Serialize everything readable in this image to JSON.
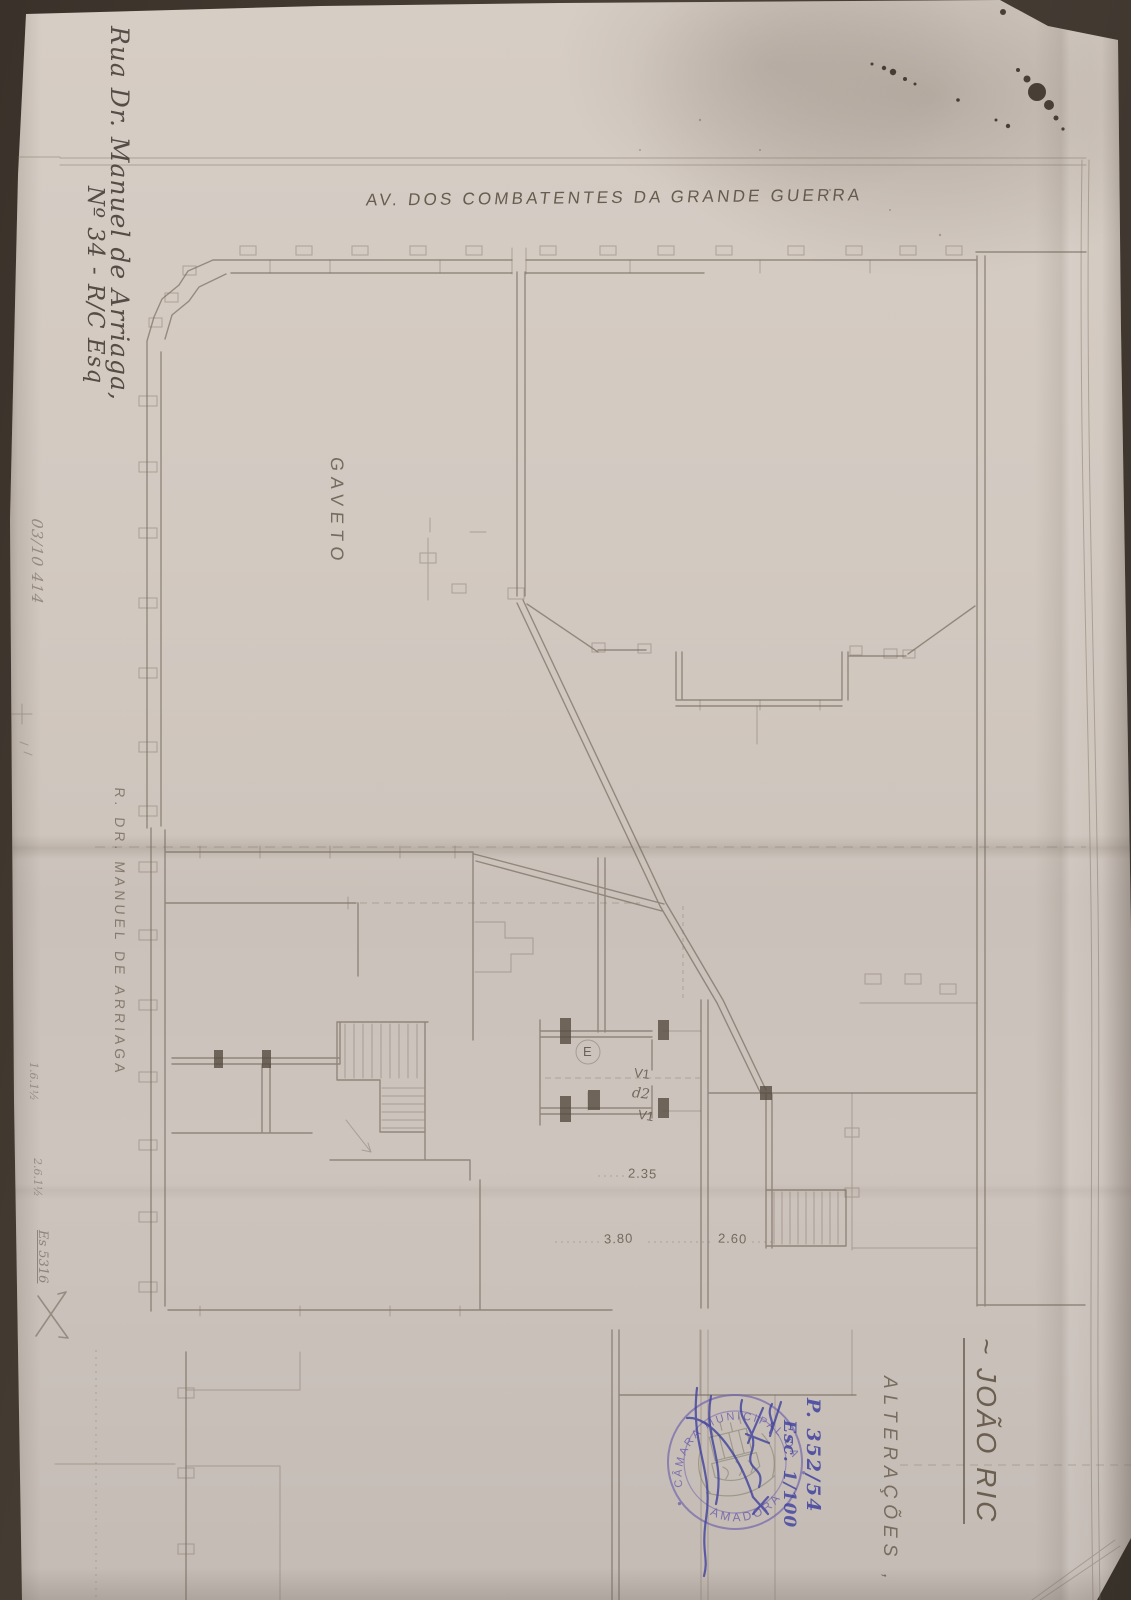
{
  "sheet": {
    "avenue_label": "AV. DOS COMBATENTES DA GRANDE GUERRA",
    "corner_label": "GAVETO",
    "street_label": "R. DR. MANUEL DE ARRIAGA",
    "address_line1": "Rua Dr. Manuel de Arriaga,",
    "address_line2": "Nº 34 - R/C Esq",
    "owner_name": "~ JOÃO RIC",
    "alterations_label": "ALTERAÇÕES ,",
    "process_number": "P. 352/54",
    "scale_label": "Esc. 1/100",
    "stamp": {
      "arc_top": "CÂMARA MUNICIPAL DA",
      "arc_bottom": "AMADORA"
    },
    "plan": {
      "entry_label": "E",
      "window_top": "V1",
      "door_label": "d2",
      "window_bottom": "V1",
      "dim_hall": "2.35",
      "dim_left": "3.80",
      "dim_right": "2.60"
    },
    "margin_notes": {
      "note_top": "03/10 414",
      "note_a": "1.6.1½",
      "note_b": "2.6.1½",
      "note_c": "Es 5316"
    },
    "colors": {
      "pencil": "#6b5f50",
      "ink_blue": "#3c3e9d",
      "stamp_violet": "#6f63ab",
      "paper": "#d2c9c1"
    }
  }
}
